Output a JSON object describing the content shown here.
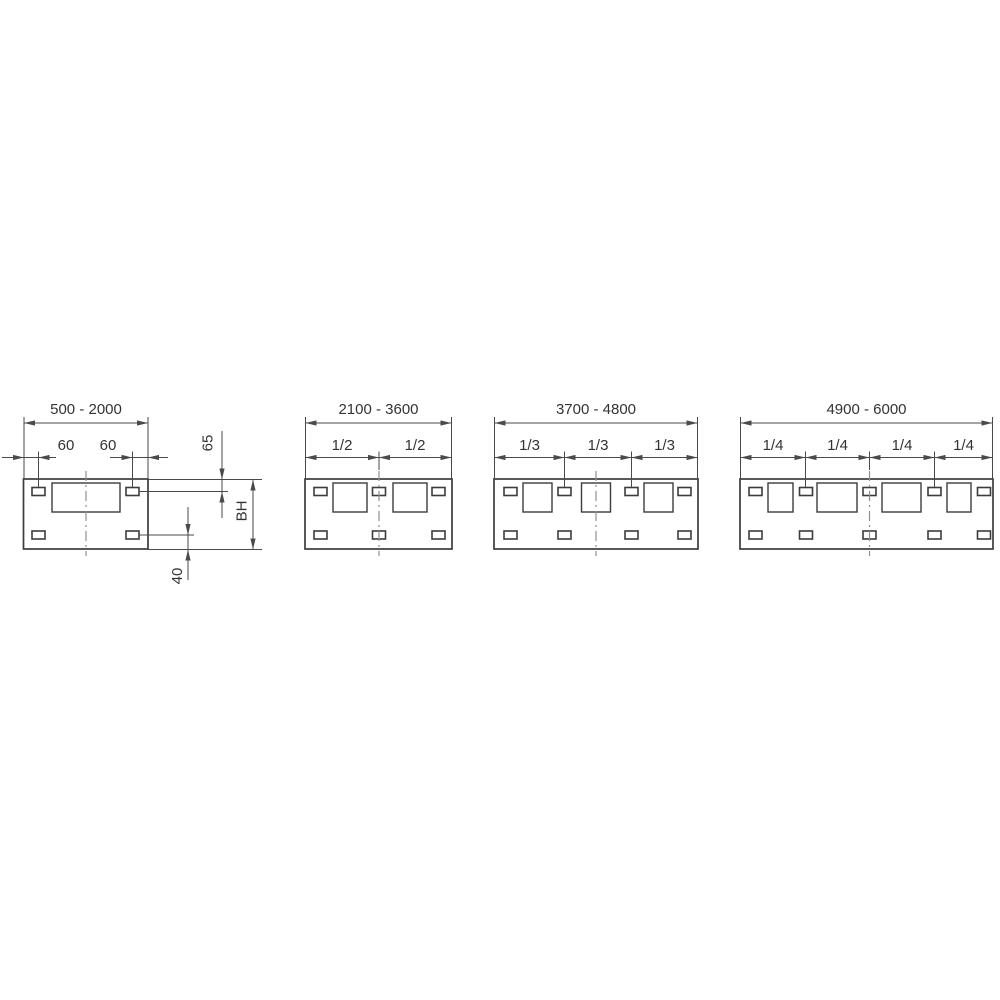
{
  "figure": {
    "background": "#ffffff",
    "line_color": "#3c3c3c",
    "dim_color": "#4a4a4a",
    "centerline_color": "#8f8f8f",
    "text_color": "#333333",
    "panels": [
      {
        "width_range": "500 - 2000",
        "window_count": 1,
        "slot_pairs": 2,
        "dims": {
          "left_slot_offset": "60",
          "right_slot_offset": "60",
          "top_slot_inset": "65",
          "panel_height": "BH",
          "bottom_slot_inset": "40"
        }
      },
      {
        "width_range": "2100 - 3600",
        "window_count": 2,
        "slot_pairs": 3,
        "segment_labels": [
          "1/2",
          "1/2"
        ]
      },
      {
        "width_range": "3700 - 4800",
        "window_count": 3,
        "slot_pairs": 4,
        "segment_labels": [
          "1/3",
          "1/3",
          "1/3"
        ]
      },
      {
        "width_range": "4900 - 6000",
        "window_count": 4,
        "slot_pairs": 5,
        "segment_labels": [
          "1/4",
          "1/4",
          "1/4",
          "1/4"
        ]
      }
    ]
  }
}
